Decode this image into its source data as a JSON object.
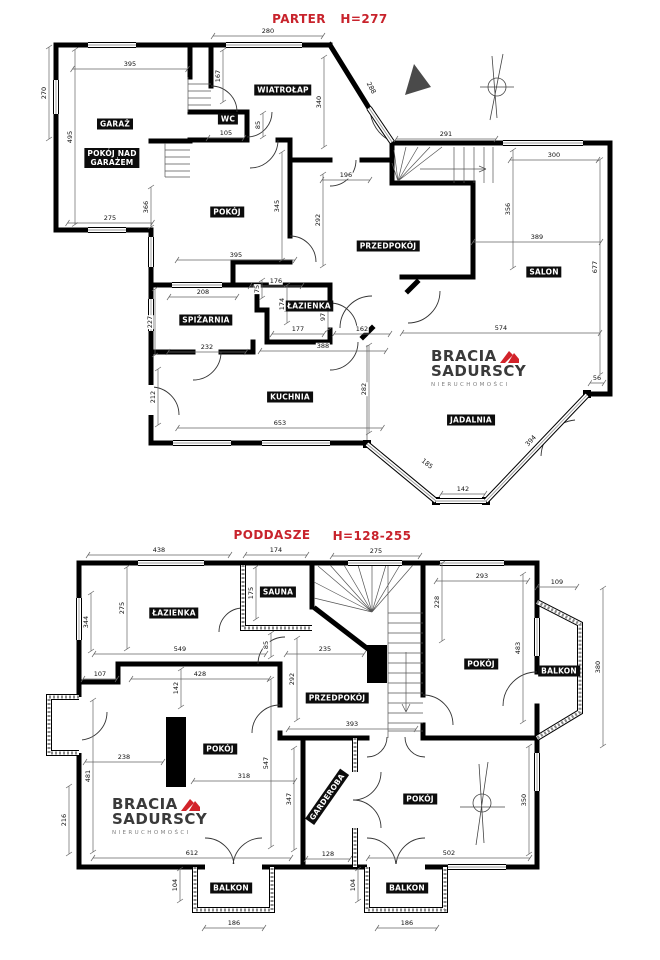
{
  "colors": {
    "wall": "#000000",
    "accent_red": "#c8232c",
    "logo_red": "#d2232a"
  },
  "logo": {
    "line1": "BRACIA",
    "line2": "SADURSCY",
    "line3": "NIERUCHOMOŚCI"
  },
  "parter": {
    "title": "PARTER",
    "height_label": "H=277",
    "icons": [
      "north-arrow",
      "compass-rose"
    ],
    "rooms": [
      {
        "t": "GARAŻ",
        "x": 115,
        "y": 124
      },
      {
        "t": "POKÓJ NAD\nGARAŻEM",
        "x": 112,
        "y": 158
      },
      {
        "t": "WIATROŁAP",
        "x": 283,
        "y": 90
      },
      {
        "t": "WC",
        "x": 228,
        "y": 119
      },
      {
        "t": "POKÓJ",
        "x": 227,
        "y": 212
      },
      {
        "t": "PRZEDPOKÓJ",
        "x": 388,
        "y": 246
      },
      {
        "t": "SALON",
        "x": 544,
        "y": 272
      },
      {
        "t": "ŁAZIENKA",
        "x": 309,
        "y": 306
      },
      {
        "t": "SPIŻARNIA",
        "x": 206,
        "y": 320
      },
      {
        "t": "KUCHNIA",
        "x": 290,
        "y": 397
      },
      {
        "t": "JADALNIA",
        "x": 471,
        "y": 420
      }
    ],
    "dims": [
      {
        "t": "270",
        "x": 44,
        "y": 93,
        "o": "v",
        "l": 92
      },
      {
        "t": "495",
        "x": 70,
        "y": 137,
        "o": "v",
        "l": 175
      },
      {
        "t": "395",
        "x": 130,
        "y": 64,
        "o": "h",
        "l": 115
      },
      {
        "t": "275",
        "x": 110,
        "y": 218,
        "o": "h",
        "l": 85
      },
      {
        "t": "366",
        "x": 146,
        "y": 207,
        "o": "v",
        "l": 40
      },
      {
        "t": "280",
        "x": 268,
        "y": 31,
        "o": "h",
        "l": 110
      },
      {
        "t": "167",
        "x": 218,
        "y": 76,
        "o": "v",
        "l": 52
      },
      {
        "t": "105",
        "x": 226,
        "y": 133,
        "o": "h",
        "l": 36
      },
      {
        "t": "85",
        "x": 258,
        "y": 125,
        "o": "v",
        "l": 24
      },
      {
        "t": "340",
        "x": 319,
        "y": 102,
        "o": "v",
        "l": 90
      },
      {
        "t": "288",
        "x": 371,
        "y": 88,
        "o": "n",
        "r": 62
      },
      {
        "t": "291",
        "x": 446,
        "y": 134,
        "o": "h",
        "l": 100
      },
      {
        "t": "300",
        "x": 554,
        "y": 155,
        "o": "h",
        "l": 88
      },
      {
        "t": "196",
        "x": 346,
        "y": 175,
        "o": "h",
        "l": 48
      },
      {
        "t": "345",
        "x": 277,
        "y": 206,
        "o": "v",
        "l": 108
      },
      {
        "t": "292",
        "x": 318,
        "y": 220,
        "o": "v",
        "l": 92
      },
      {
        "t": "356",
        "x": 508,
        "y": 209,
        "o": "v",
        "l": 118
      },
      {
        "t": "389",
        "x": 537,
        "y": 237,
        "o": "h",
        "l": 128
      },
      {
        "t": "677",
        "x": 595,
        "y": 267,
        "o": "v",
        "l": 215
      },
      {
        "t": "395",
        "x": 236,
        "y": 255,
        "o": "h",
        "l": 118
      },
      {
        "t": "208",
        "x": 203,
        "y": 292,
        "o": "h",
        "l": 68
      },
      {
        "t": "176",
        "x": 276,
        "y": 281,
        "o": "h",
        "l": 52
      },
      {
        "t": "75",
        "x": 257,
        "y": 289,
        "o": "v",
        "l": 18
      },
      {
        "t": "174",
        "x": 282,
        "y": 304,
        "o": "v",
        "l": 38
      },
      {
        "t": "97",
        "x": 323,
        "y": 317,
        "o": "v",
        "l": 26
      },
      {
        "t": "177",
        "x": 298,
        "y": 329,
        "o": "h",
        "l": 52
      },
      {
        "t": "162",
        "x": 362,
        "y": 329,
        "o": "h",
        "l": 56
      },
      {
        "t": "388",
        "x": 323,
        "y": 346,
        "o": "h",
        "l": 126
      },
      {
        "t": "227",
        "x": 150,
        "y": 322,
        "o": "v",
        "l": 66
      },
      {
        "t": "232",
        "x": 207,
        "y": 347,
        "o": "h",
        "l": 78
      },
      {
        "t": "212",
        "x": 153,
        "y": 397,
        "o": "v",
        "l": 56
      },
      {
        "t": "282",
        "x": 364,
        "y": 389,
        "o": "v",
        "l": 88
      },
      {
        "t": "653",
        "x": 280,
        "y": 423,
        "o": "h",
        "l": 205
      },
      {
        "t": "574",
        "x": 501,
        "y": 328,
        "o": "h",
        "l": 198
      },
      {
        "t": "56",
        "x": 597,
        "y": 378,
        "o": "h",
        "l": 14
      },
      {
        "t": "185",
        "x": 427,
        "y": 464,
        "o": "n",
        "r": 38
      },
      {
        "t": "142",
        "x": 463,
        "y": 489,
        "o": "h",
        "l": 44
      },
      {
        "t": "394",
        "x": 531,
        "y": 441,
        "o": "n",
        "r": -47
      }
    ]
  },
  "poddasze": {
    "title": "PODDASZE",
    "height_label": "H=128-255",
    "icons": [
      "compass-rose"
    ],
    "rooms": [
      {
        "t": "ŁAZIENKA",
        "x": 174,
        "y": 613
      },
      {
        "t": "SAUNA",
        "x": 278,
        "y": 592
      },
      {
        "t": "PRZEDPOKÓJ",
        "x": 337,
        "y": 698
      },
      {
        "t": "POKÓJ",
        "x": 481,
        "y": 664
      },
      {
        "t": "BALKON",
        "x": 559,
        "y": 671
      },
      {
        "t": "POKÓJ",
        "x": 220,
        "y": 749
      },
      {
        "t": "GARDEROBA",
        "x": 327,
        "y": 797,
        "r": -55
      },
      {
        "t": "POKÓJ",
        "x": 420,
        "y": 799
      },
      {
        "t": "BALKON",
        "x": 231,
        "y": 888
      },
      {
        "t": "BALKON",
        "x": 407,
        "y": 888
      }
    ],
    "dims": [
      {
        "t": "438",
        "x": 159,
        "y": 550,
        "o": "h",
        "l": 142
      },
      {
        "t": "174",
        "x": 276,
        "y": 550,
        "o": "h",
        "l": 62
      },
      {
        "t": "275",
        "x": 376,
        "y": 551,
        "o": "h",
        "l": 88
      },
      {
        "t": "293",
        "x": 482,
        "y": 576,
        "o": "h",
        "l": 92
      },
      {
        "t": "109",
        "x": 557,
        "y": 582,
        "o": "h",
        "l": 40
      },
      {
        "t": "344",
        "x": 86,
        "y": 622,
        "o": "v",
        "l": 58
      },
      {
        "t": "275",
        "x": 122,
        "y": 608,
        "o": "v",
        "l": 82
      },
      {
        "t": "175",
        "x": 251,
        "y": 593,
        "o": "v",
        "l": 52
      },
      {
        "t": "228",
        "x": 437,
        "y": 602,
        "o": "v",
        "l": 78
      },
      {
        "t": "483",
        "x": 518,
        "y": 648,
        "o": "v",
        "l": 148
      },
      {
        "t": "380",
        "x": 598,
        "y": 667,
        "o": "v",
        "l": 158
      },
      {
        "t": "549",
        "x": 180,
        "y": 649,
        "o": "h",
        "l": 172
      },
      {
        "t": "85",
        "x": 266,
        "y": 645,
        "o": "v",
        "l": 24
      },
      {
        "t": "235",
        "x": 325,
        "y": 649,
        "o": "h",
        "l": 78
      },
      {
        "t": "107",
        "x": 100,
        "y": 674,
        "o": "h",
        "l": 34
      },
      {
        "t": "428",
        "x": 200,
        "y": 674,
        "o": "h",
        "l": 138
      },
      {
        "t": "142",
        "x": 176,
        "y": 688,
        "o": "v",
        "l": 38
      },
      {
        "t": "292",
        "x": 292,
        "y": 679,
        "o": "v",
        "l": 82
      },
      {
        "t": "393",
        "x": 352,
        "y": 724,
        "o": "h",
        "l": 128
      },
      {
        "t": "238",
        "x": 124,
        "y": 757,
        "o": "h",
        "l": 78
      },
      {
        "t": "318",
        "x": 244,
        "y": 776,
        "o": "h",
        "l": 102
      },
      {
        "t": "547",
        "x": 266,
        "y": 763,
        "o": "v",
        "l": 168
      },
      {
        "t": "347",
        "x": 289,
        "y": 799,
        "o": "v",
        "l": 102
      },
      {
        "t": "481",
        "x": 88,
        "y": 776,
        "o": "v",
        "l": 152
      },
      {
        "t": "216",
        "x": 64,
        "y": 820,
        "o": "v",
        "l": 68
      },
      {
        "t": "612",
        "x": 192,
        "y": 853,
        "o": "h",
        "l": 198
      },
      {
        "t": "128",
        "x": 328,
        "y": 854,
        "o": "h",
        "l": 44
      },
      {
        "t": "502",
        "x": 449,
        "y": 853,
        "o": "h",
        "l": 162
      },
      {
        "t": "350",
        "x": 524,
        "y": 800,
        "o": "v",
        "l": 108
      },
      {
        "t": "104",
        "x": 175,
        "y": 885,
        "o": "v",
        "l": 32
      },
      {
        "t": "186",
        "x": 234,
        "y": 923,
        "o": "h",
        "l": 60
      },
      {
        "t": "104",
        "x": 353,
        "y": 885,
        "o": "v",
        "l": 32
      },
      {
        "t": "186",
        "x": 407,
        "y": 923,
        "o": "h",
        "l": 60
      }
    ]
  }
}
